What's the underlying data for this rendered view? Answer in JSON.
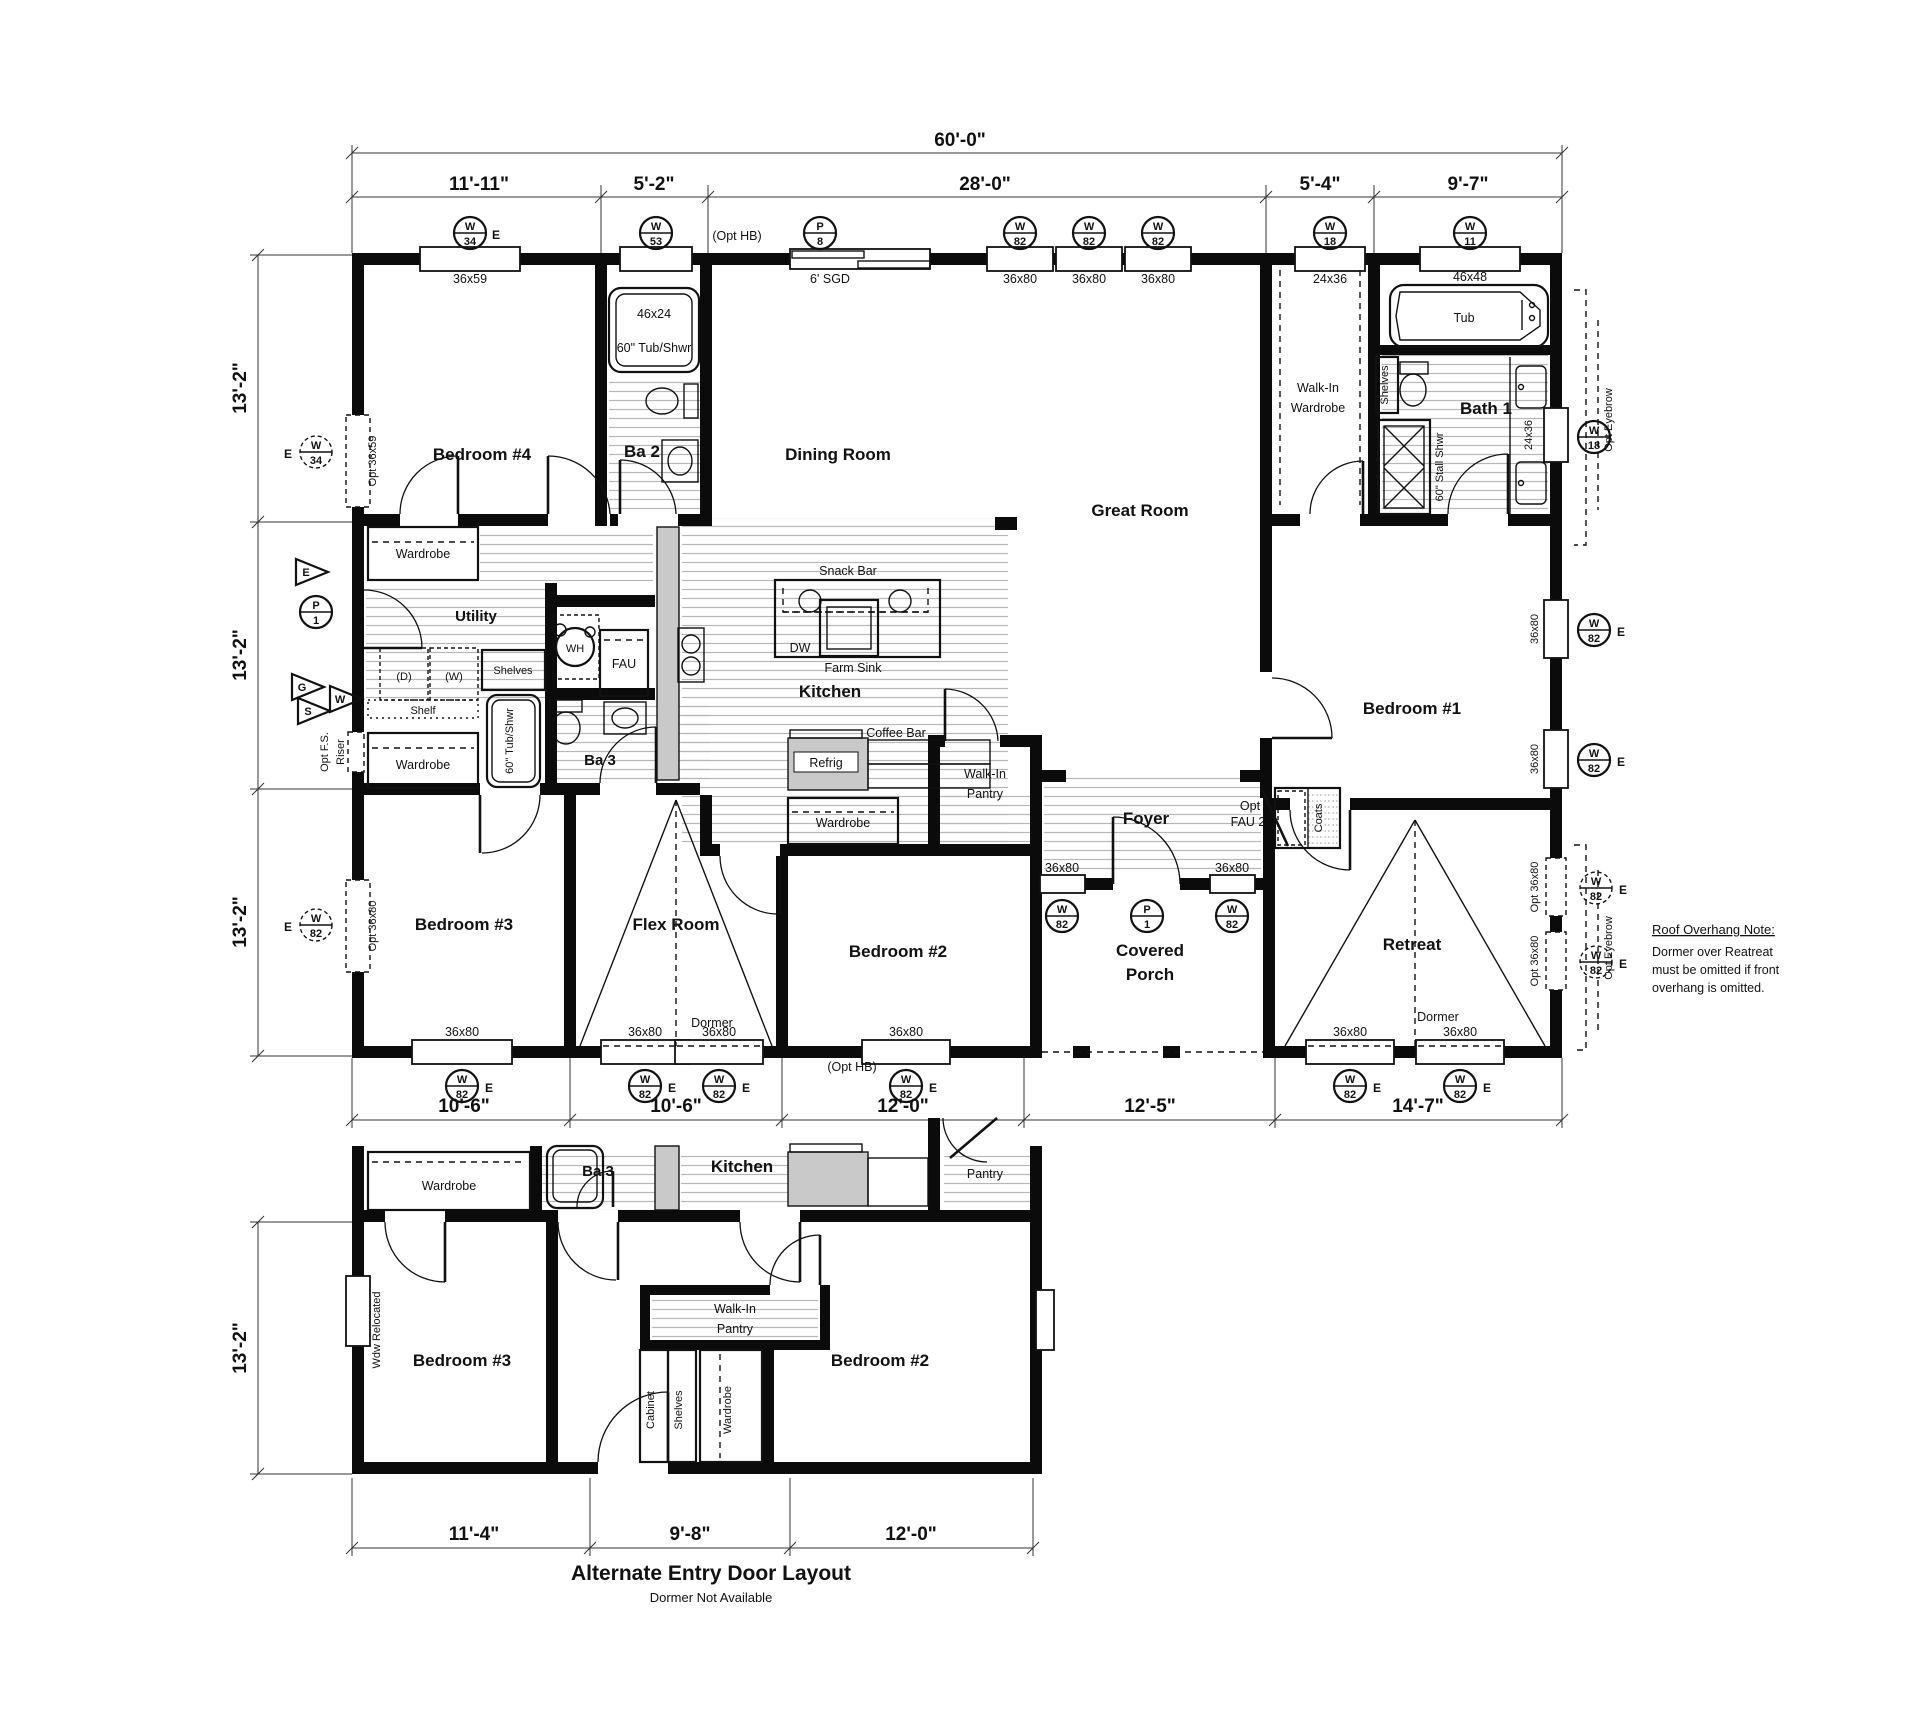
{
  "plan": {
    "overall_width": "60'-0\"",
    "top_dims": [
      "11'-11\"",
      "5'-2\"",
      "28'-0\"",
      "5'-4\"",
      "9'-7\""
    ],
    "left_dims": [
      "13'-2\"",
      "13'-2\"",
      "13'-2\""
    ],
    "bottom_dims": [
      "10'-6\"",
      "10'-6\"",
      "12'-0\"",
      "12'-5\"",
      "14'-7\""
    ]
  },
  "alt_plan": {
    "title": "Alternate Entry Door Layout",
    "subtitle": "Dormer Not Available",
    "left_dim": "13'-2\"",
    "bottom_dims": [
      "11'-4\"",
      "9'-8\"",
      "12'-0\""
    ]
  },
  "rooms": {
    "bedroom1": "Bedroom #1",
    "bedroom2": "Bedroom #2",
    "bedroom3": "Bedroom #3",
    "bedroom4": "Bedroom #4",
    "ba2": "Ba 2",
    "ba3": "Ba 3",
    "bath1": "Bath 1",
    "dining": "Dining Room",
    "great": "Great Room",
    "kitchen": "Kitchen",
    "utility": "Utility",
    "flex": "Flex Room",
    "foyer": "Foyer",
    "retreat": "Retreat",
    "covered1": "Covered",
    "covered2": "Porch",
    "wiw1": "Walk-In",
    "wiw2": "Wardrobe",
    "wip1": "Walk-In",
    "wip2": "Pantry"
  },
  "features": {
    "wardrobe": "Wardrobe",
    "shelves": "Shelves",
    "shelf": "Shelf",
    "dryer": "(D)",
    "washer": "(W)",
    "wh": "WH",
    "fau": "FAU",
    "tub": "Tub",
    "tub_shwr": "60\" Tub/Shwr",
    "stall_shwr": "60\" Stall Shwr",
    "snack_bar": "Snack Bar",
    "dw": "DW",
    "farm_sink": "Farm Sink",
    "coffee_bar": "Coffee Bar",
    "refrig": "Refrig",
    "coats": "Coats",
    "opt": "Opt",
    "fau2": "FAU 2",
    "dormer": "Dormer",
    "pantry": "Pantry",
    "cabinet": "Cabinet",
    "opt_eyebrow": "Opt Eyebrow",
    "opt_fs": "Opt F.S.",
    "riser": "Riser",
    "wdw_relocated": "Wdw Relocated",
    "opt_hb": "(Opt HB)",
    "sgd": "6' SGD"
  },
  "sizes": {
    "s3659": "36x59",
    "opt3659": "Opt 36x59",
    "s4624": "46x24",
    "s3680": "36x80",
    "opt3680": "Opt 36x80",
    "s2436": "24x36",
    "s4648": "46x48"
  },
  "tags": {
    "w": "W",
    "p": "P",
    "e": "E",
    "g": "G",
    "s": "S",
    "n1": "1",
    "n8": "8",
    "n11": "11",
    "n18": "18",
    "n34": "34",
    "n53": "53",
    "n82": "82"
  },
  "note": {
    "title": "Roof Overhang Note:",
    "line1": "Dormer over Reatreat",
    "line2": "must be omitted if front",
    "line3": "overhang is omitted."
  }
}
